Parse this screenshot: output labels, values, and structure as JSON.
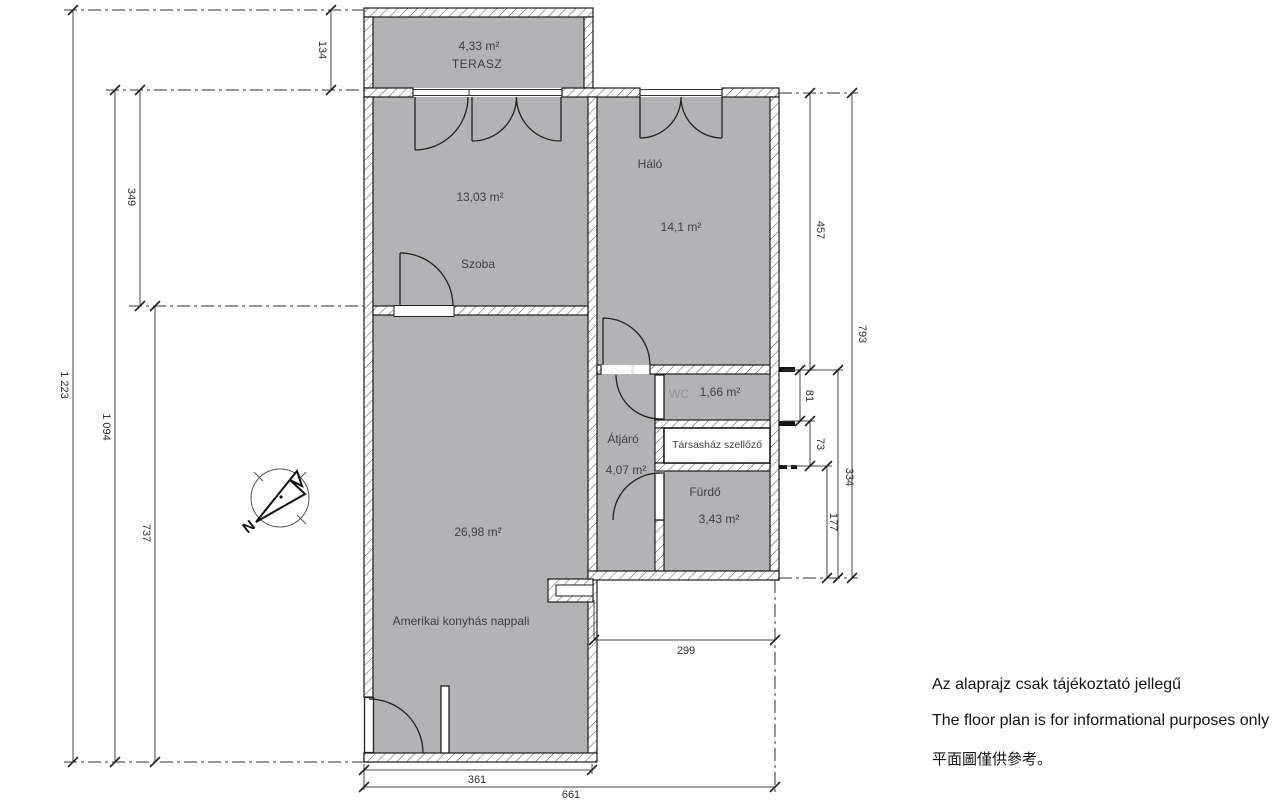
{
  "plan": {
    "rooms": {
      "terasz": {
        "area": "4,33 m²",
        "name": "TERASZ"
      },
      "szoba": {
        "area": "13,03 m²",
        "name": "Szoba"
      },
      "halo": {
        "name": "Háló",
        "area": "14,1 m²"
      },
      "wc": {
        "name": "WC",
        "area": "1,66 m²"
      },
      "atjaro": {
        "name": "Átjáró",
        "area": "4,07 m²"
      },
      "szellozo": {
        "name": "Társasház szellőző"
      },
      "furdo": {
        "name": "Fürdő",
        "area": "3,43 m²"
      },
      "nappali": {
        "area": "26,98 m²",
        "name": "Amerikai konyhás nappali"
      }
    },
    "dims": {
      "top_terrace": "134",
      "left_total": "1 223",
      "left_apartment": "1 094",
      "left_szoba": "349",
      "left_nappali": "737",
      "right_halo": "457",
      "right_total": "793",
      "right_wc": "81",
      "right_szellozo": "73",
      "right_block": "334",
      "right_furdo": "177",
      "bottom_offset": "299",
      "bottom_nappali": "361",
      "bottom_total": "661"
    },
    "compass": {
      "north": "N"
    },
    "watermark": {
      "text": "GDN"
    }
  },
  "disclaimer": {
    "hu": "Az alaprajz csak tájékoztató jellegű",
    "en": "The floor plan is for informational purposes only",
    "zh": "平面圖僅供參考。"
  },
  "colors": {
    "room_fill": "#b3b3b6",
    "wall_line": "#1a1a1a",
    "dim_line": "#444444"
  }
}
